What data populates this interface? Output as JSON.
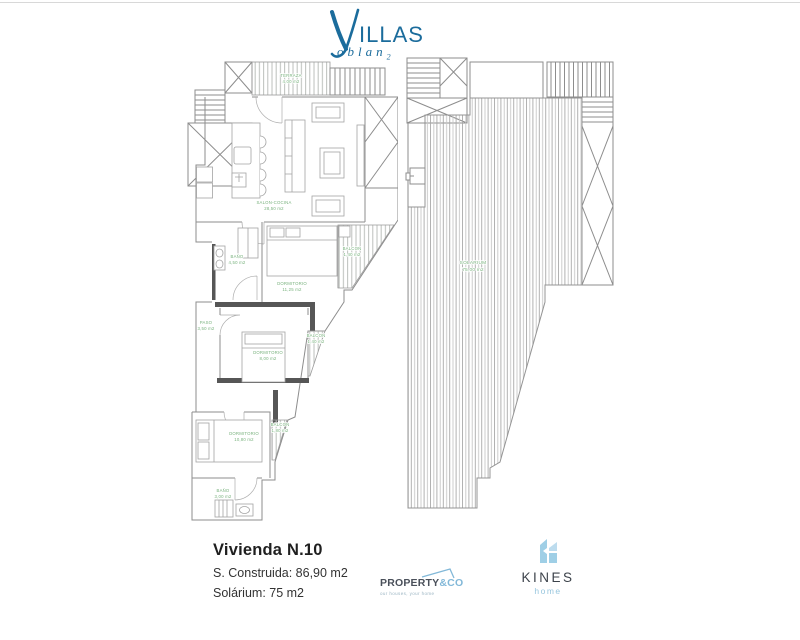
{
  "brand": {
    "initial": "V",
    "word": "ILLAS",
    "sub_word": "oblan",
    "sub_index": "2"
  },
  "plans": {
    "left": {
      "rooms": [
        {
          "label": "TERRAZA",
          "area": "4,00 m2"
        },
        {
          "label": "SALON-COCINA",
          "area": "28,50 m2"
        },
        {
          "label": "BAÑO",
          "area": "4,50 m2"
        },
        {
          "label": "DORMITORIO",
          "area": "11,25 m2"
        },
        {
          "label": "BALCON",
          "area": "1,40 m2"
        },
        {
          "label": "PASO",
          "area": "3,50 m2"
        },
        {
          "label": "DORMITORIO",
          "area": "8,00 m2"
        },
        {
          "label": "BALCON",
          "area": "1,40 m2"
        },
        {
          "label": "DORMITORIO",
          "area": "10,80 m2"
        },
        {
          "label": "BALCON",
          "area": "1,80 m2"
        },
        {
          "label": "BAÑO",
          "area": "3,00 m2"
        }
      ]
    },
    "right": {
      "rooms": [
        {
          "label": "SOLARIUM",
          "area": "75,00 m2"
        }
      ]
    }
  },
  "details": {
    "title": "Vivienda N.10",
    "built_area": "S. Construida: 86,90 m2",
    "solarium": "Solárium: 75 m2"
  },
  "partners": {
    "property": {
      "name": "PROPERTY",
      "suffix": "&CO",
      "tagline": "our houses, your home"
    },
    "kines": {
      "name": "KINES",
      "subtitle": "home"
    }
  },
  "colors": {
    "brand_blue": "#1b6c9c",
    "label_green": "#79b27e",
    "property_accent": "#82b8d8",
    "kines_accent": "#9fcfe6"
  }
}
